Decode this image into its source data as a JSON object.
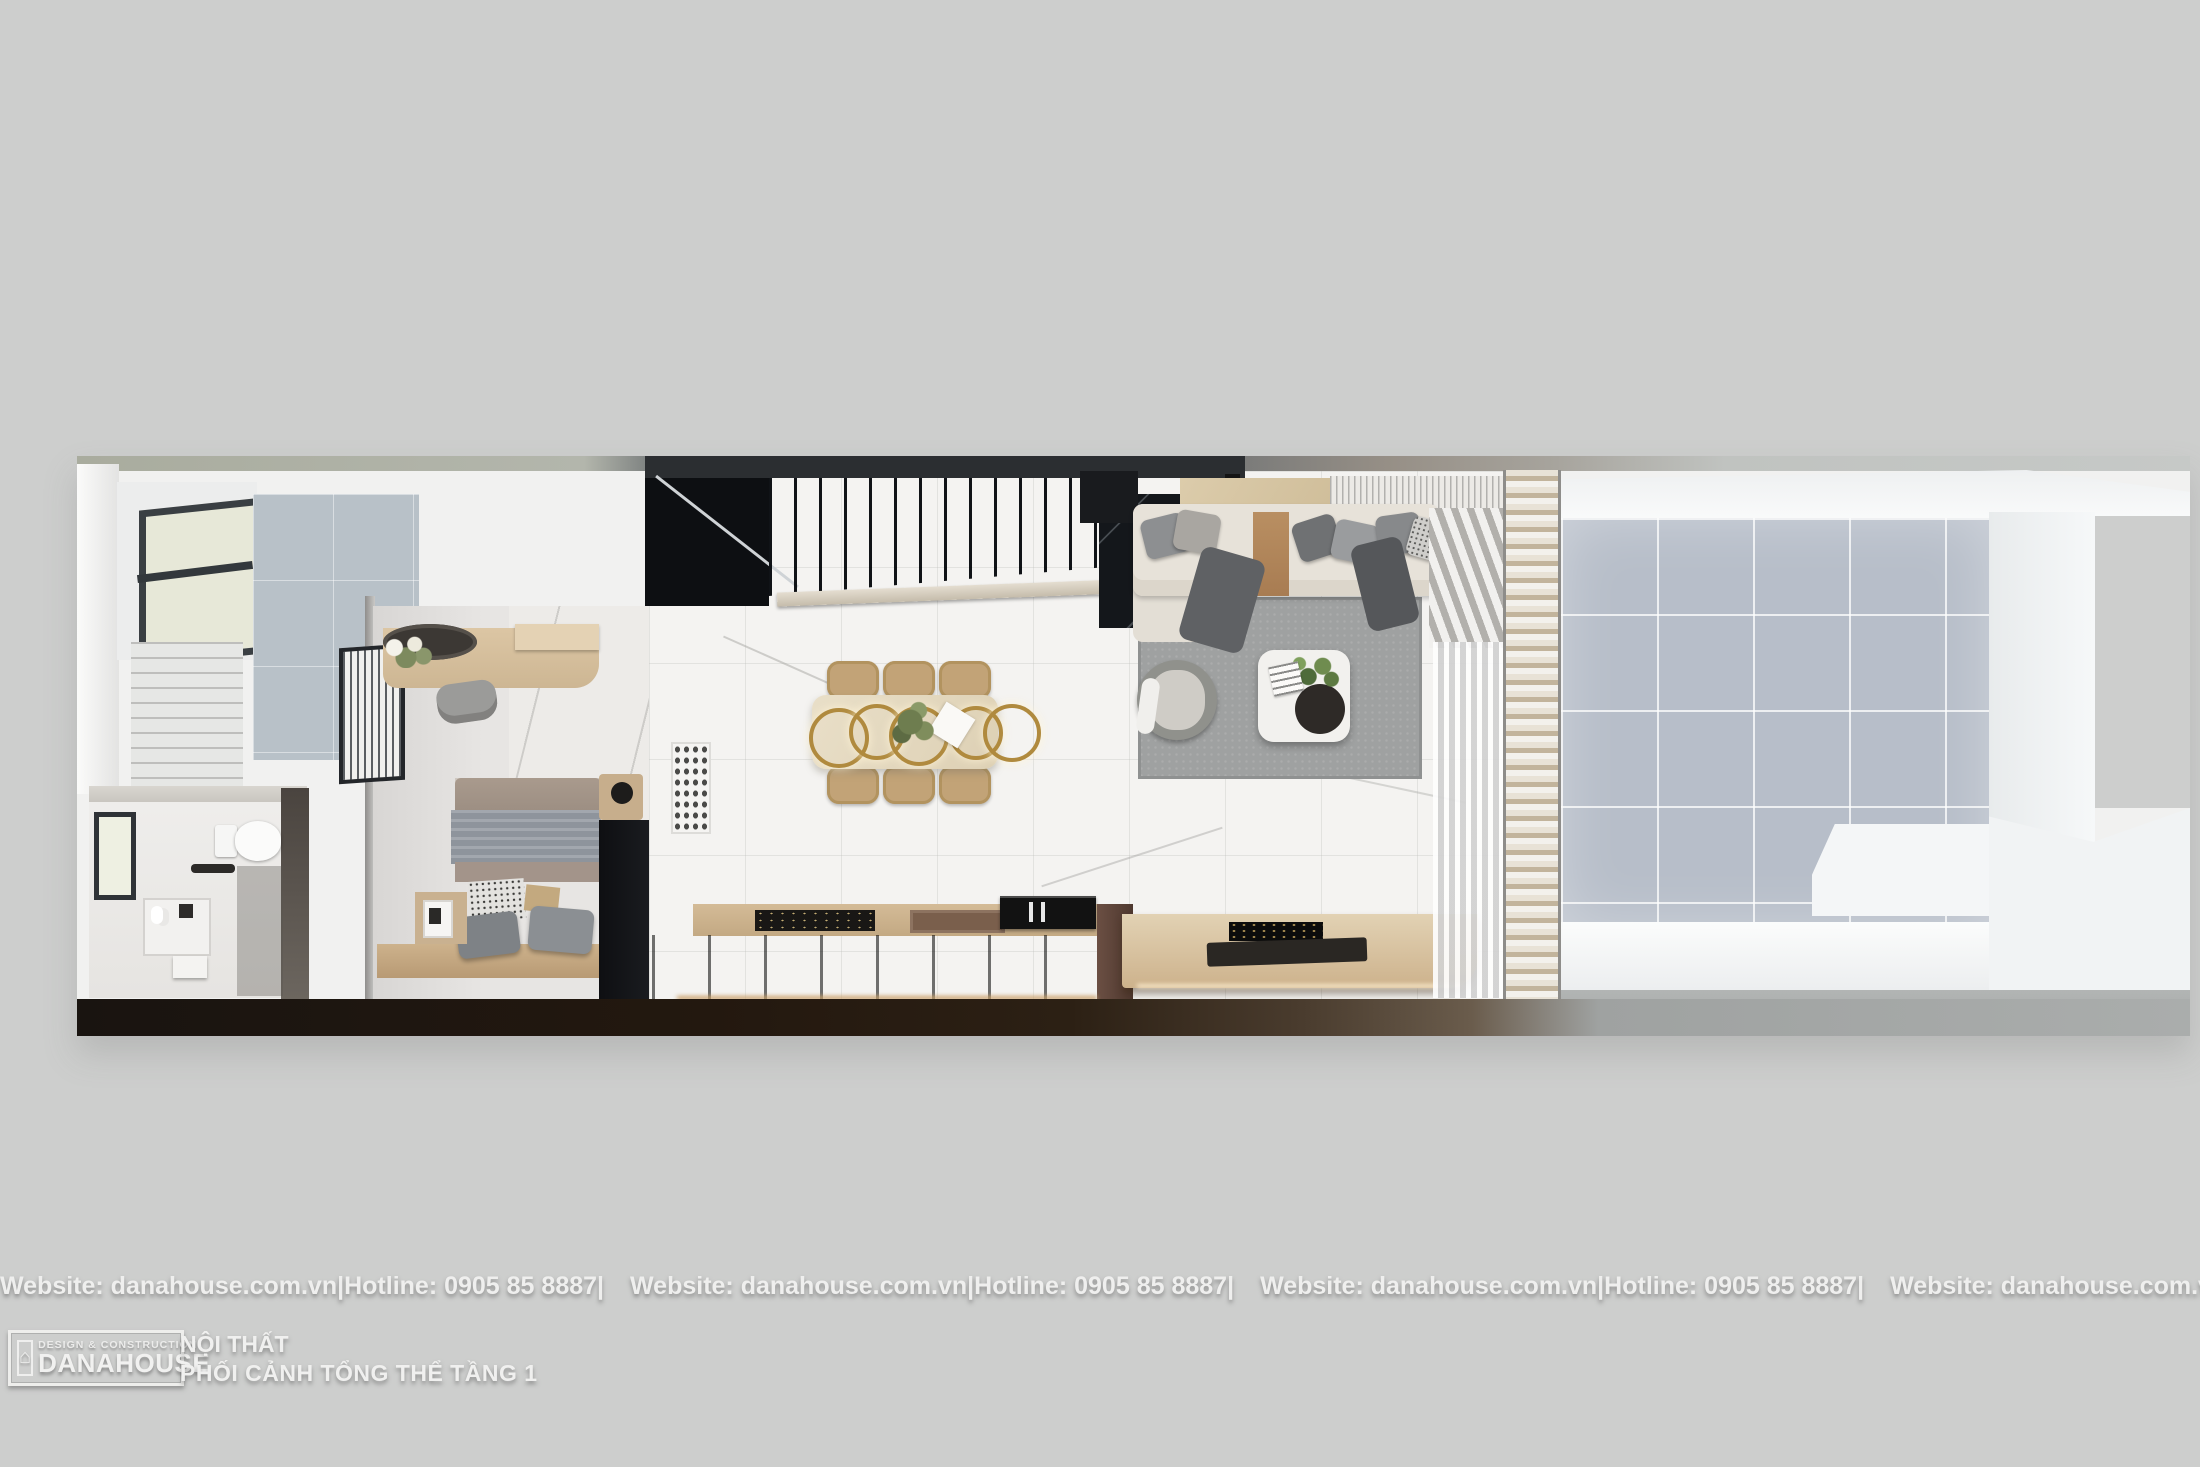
{
  "watermark": {
    "website": "Website: danahouse.com.vn",
    "hotline": "Hotline: 0905 85 8887",
    "separator": "|"
  },
  "footer": {
    "logo": {
      "tagline": "DESIGN & CONSTRUCTION",
      "brand": "DANAHOUSE"
    },
    "caption_line1": "NỘI THẤT",
    "caption_line2": "PHỐI CẢNH TỔNG THỂ TẦNG 1"
  },
  "icons": {
    "logo_house": "⌂"
  },
  "palette": {
    "background": "#cdcecd",
    "marble_floor": "#f3f2f0",
    "courtyard_tile": "#b7bec9",
    "stair_dark": "#10141a",
    "wood": "#cdb391",
    "gold_ring": "#b08a3e",
    "rug": "#9fa1a1",
    "sofa": "#e7e2d9",
    "kitchen_cabinet": "#46403a",
    "wardrobe_black": "#141518",
    "bathroom_tile_wall": "#b8c1c8"
  }
}
